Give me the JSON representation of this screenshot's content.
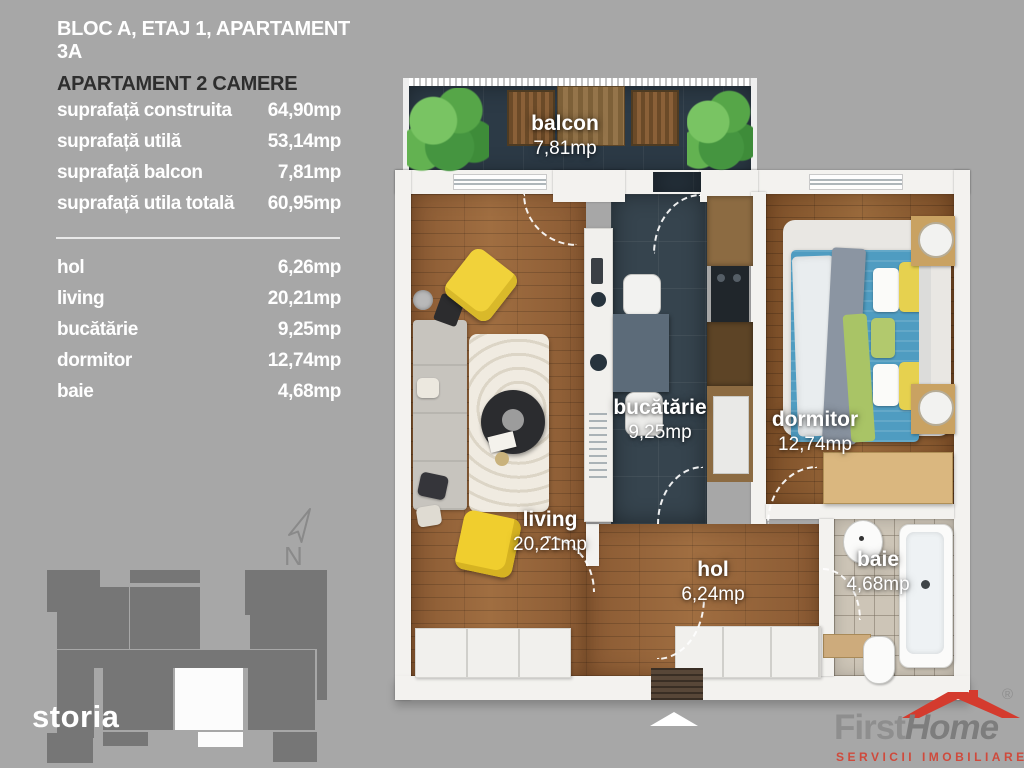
{
  "header": {
    "line1": "BLOC A, ETAJ 1, APARTAMENT 3A",
    "line2": "APARTAMENT 2 CAMERE"
  },
  "surface_table": {
    "rows": [
      {
        "label": "suprafață construita",
        "value": "64,90mp"
      },
      {
        "label": "suprafață utilă",
        "value": "53,14mp"
      },
      {
        "label": "suprafață balcon",
        "value": "7,81mp"
      },
      {
        "label": "suprafață utila totală",
        "value": "60,95mp"
      }
    ]
  },
  "room_table": {
    "rows": [
      {
        "label": "hol",
        "value": "6,26mp"
      },
      {
        "label": "living",
        "value": "20,21mp"
      },
      {
        "label": "bucătărie",
        "value": "9,25mp"
      },
      {
        "label": "dormitor",
        "value": "12,74mp"
      },
      {
        "label": "baie",
        "value": "4,68mp"
      }
    ]
  },
  "compass": {
    "label": "N"
  },
  "floorplan": {
    "balcon": {
      "name": "balcon",
      "area": "7,81mp"
    },
    "living": {
      "name": "living",
      "area": "20,21mp"
    },
    "bucatarie": {
      "name": "bucătărie",
      "area": "9,25mp"
    },
    "dormitor": {
      "name": "dormitor",
      "area": "12,74mp"
    },
    "hol": {
      "name": "hol",
      "area": "6,24mp"
    },
    "baie": {
      "name": "baie",
      "area": "4,68mp"
    }
  },
  "logos": {
    "storia": "storia",
    "firsthome": {
      "first": "First",
      "home": "Home",
      "registered": "®",
      "tagline": "SERVICII IMOBILIARE"
    }
  },
  "colors": {
    "background": "#a7a7a7",
    "wall_white": "#f3f2ef",
    "wood_floor": "#95643b",
    "kitchen_slate": "#36444e",
    "bath_tile": "#cdc5b7",
    "accent_yellow": "#f1d23a",
    "bed_blue": "#4f9cc1",
    "silhouette_gray": "#767676",
    "logo_red": "#cf4a3c"
  }
}
